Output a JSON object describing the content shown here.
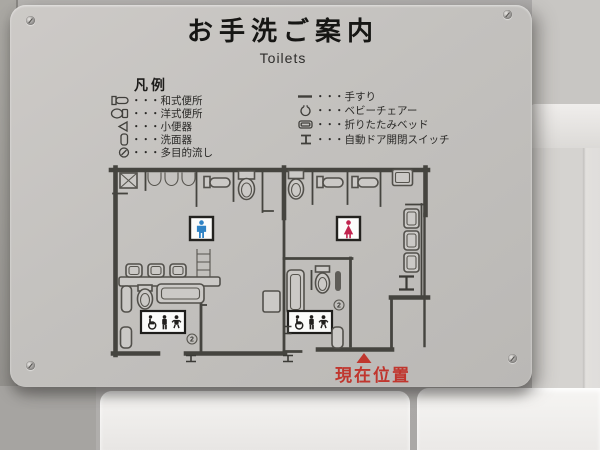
{
  "sign": {
    "title": "お手洗ご案内",
    "subtitle": "Toilets"
  },
  "legend": {
    "heading": "凡例",
    "dots": "・・・",
    "left_items": [
      {
        "icon": "japanese-squat-toilet-icon",
        "label": "和式便所"
      },
      {
        "icon": "western-toilet-icon",
        "label": "洋式便所"
      },
      {
        "icon": "urinal-icon",
        "label": "小便器"
      },
      {
        "icon": "washbasin-icon",
        "label": "洗面器"
      },
      {
        "icon": "multipurpose-sink-icon",
        "label": "多目的流し"
      }
    ],
    "right_items": [
      {
        "icon": "handrail-icon",
        "label": "手すり"
      },
      {
        "icon": "baby-chair-icon",
        "label": "ベビーチェアー"
      },
      {
        "icon": "folding-bed-icon",
        "label": "折りたたみベッド"
      },
      {
        "icon": "door-switch-icon",
        "label": "自動ドア開閉スイッチ"
      }
    ]
  },
  "plan": {
    "current_location_label": "現在位置",
    "multipurpose_mark": "2"
  },
  "colors": {
    "male_blue": "#2f83c5",
    "female_red": "#c1244e",
    "location_red": "#c0362e"
  }
}
